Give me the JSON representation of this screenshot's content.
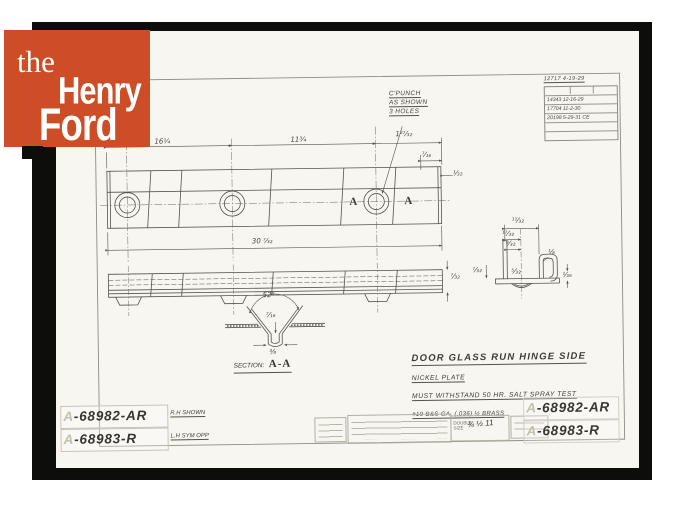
{
  "logo": {
    "word_the": "the",
    "word_henry": "Henry",
    "word_ford": "Ford",
    "bg_color": "#cd4e26"
  },
  "revision_table": {
    "top_entry": "12717  4-19-29",
    "rows": [
      "14343  12-16-29",
      "17704  11-2-30",
      "20198  5-29-31 CE"
    ]
  },
  "punch_note": {
    "line1": "C'PUNCH",
    "line2": "AS SHOWN",
    "line3": "3 HOLES"
  },
  "plan_dims": {
    "d16": "16¼",
    "d11": "11¾",
    "d127": "1²⁷⁄₃₂",
    "d716": "⁷⁄₁₆",
    "d132": "¹⁄₃₂",
    "overall": "30 ⁷⁄₃₂"
  },
  "section_marks": {
    "left": "A",
    "right": "A"
  },
  "side_dims": {
    "end": "⁷⁄₃₂"
  },
  "section": {
    "angle": "52°",
    "depth": "⁷⁄₁₆",
    "width": "³⁄₈",
    "label_prefix": "SECTION:",
    "label_name": "A-A"
  },
  "profile_dims": {
    "p1": "¹¹⁄₃₂",
    "p2": "¹⁷⁄₃₂",
    "p3": "⁹⁄₃₂",
    "p4": "⁷⁄₃₂",
    "p5": "⅛",
    "p6": "⁵⁄₃₂",
    "p7": "¹⁄₁₆"
  },
  "title_block": {
    "title": "DOOR GLASS RUN HINGE SIDE",
    "note1": "NICKEL PLATE",
    "note2": "MUST WITHSTAND 50 HR. SALT SPRAY TEST",
    "note3": "#19 B&S GA. (.036) ½ BRASS"
  },
  "part_numbers": {
    "left_row1": {
      "prefix": "A",
      "number": "-68982-AR",
      "note": "R.H SHOWN"
    },
    "left_row2": {
      "prefix": "A",
      "number": "-68983-R",
      "note": "L.H SYM OPP"
    },
    "right_row1": {
      "prefix": "A",
      "number": "-68982-AR"
    },
    "right_row2": {
      "prefix": "A",
      "number": "-68983-R"
    }
  },
  "scale_box": {
    "line1": "DOUBLE",
    "line2": "SIZE",
    "marks": "¾ ½ 11"
  }
}
